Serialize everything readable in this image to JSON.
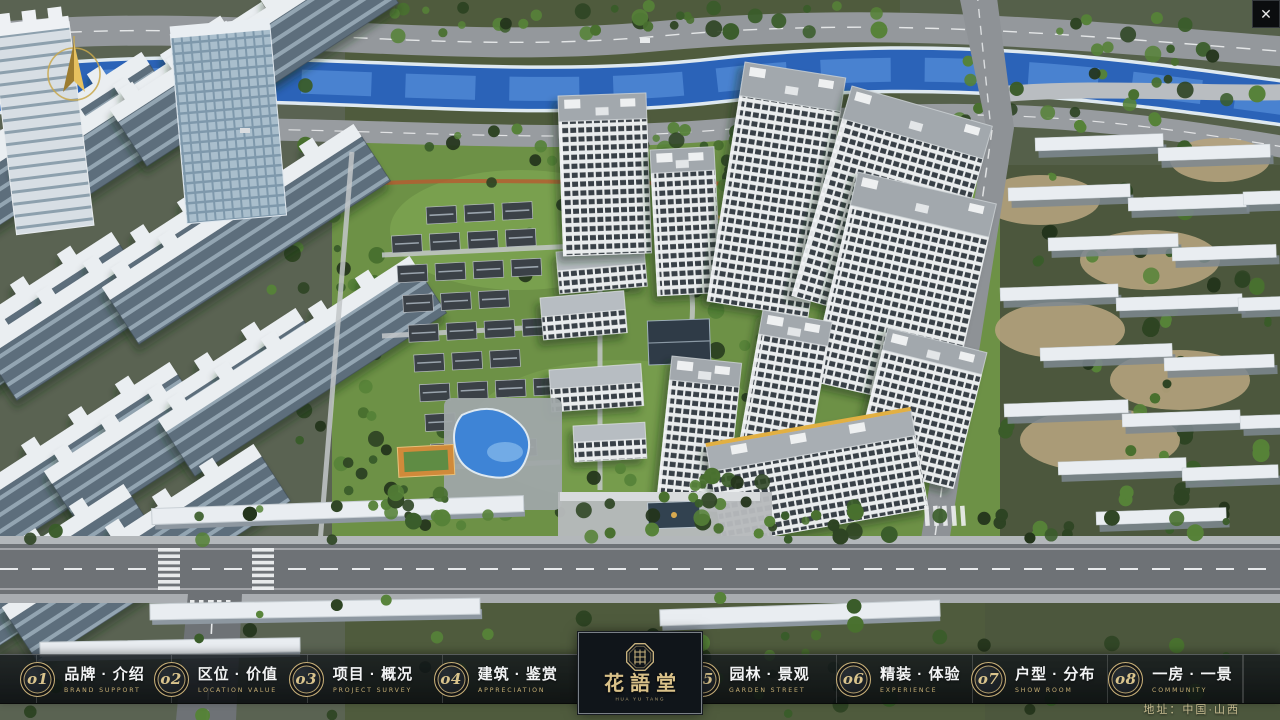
{
  "app": {
    "close_label": "✕"
  },
  "nav": {
    "items": [
      {
        "num": "o1",
        "cn": "品牌 · 介绍",
        "en": "BRAND SUPPORT"
      },
      {
        "num": "o2",
        "cn": "区位 · 价值",
        "en": "LOCATION VALUE"
      },
      {
        "num": "o3",
        "cn": "项目 · 概况",
        "en": "PROJECT SURVEY"
      },
      {
        "num": "o4",
        "cn": "建筑 · 鉴赏",
        "en": "APPRECIATION"
      },
      {
        "num": "o5",
        "cn": "园林 · 景观",
        "en": "GARDEN STREET"
      },
      {
        "num": "o6",
        "cn": "精装 · 体验",
        "en": "EXPERIENCE"
      },
      {
        "num": "o7",
        "cn": "户型 · 分布",
        "en": "SHOW ROOM"
      },
      {
        "num": "o8",
        "cn": "一房 · 一景",
        "en": "COMMUNITY"
      }
    ]
  },
  "logo": {
    "title": "花語堂",
    "subtitle": "HUA YU TANG"
  },
  "footer": {
    "address": "地址：中国·山西"
  },
  "colors": {
    "gold": "#c9b37e",
    "bar_bg": "rgba(13,17,21,0.82)",
    "river": "#2b63b8"
  }
}
